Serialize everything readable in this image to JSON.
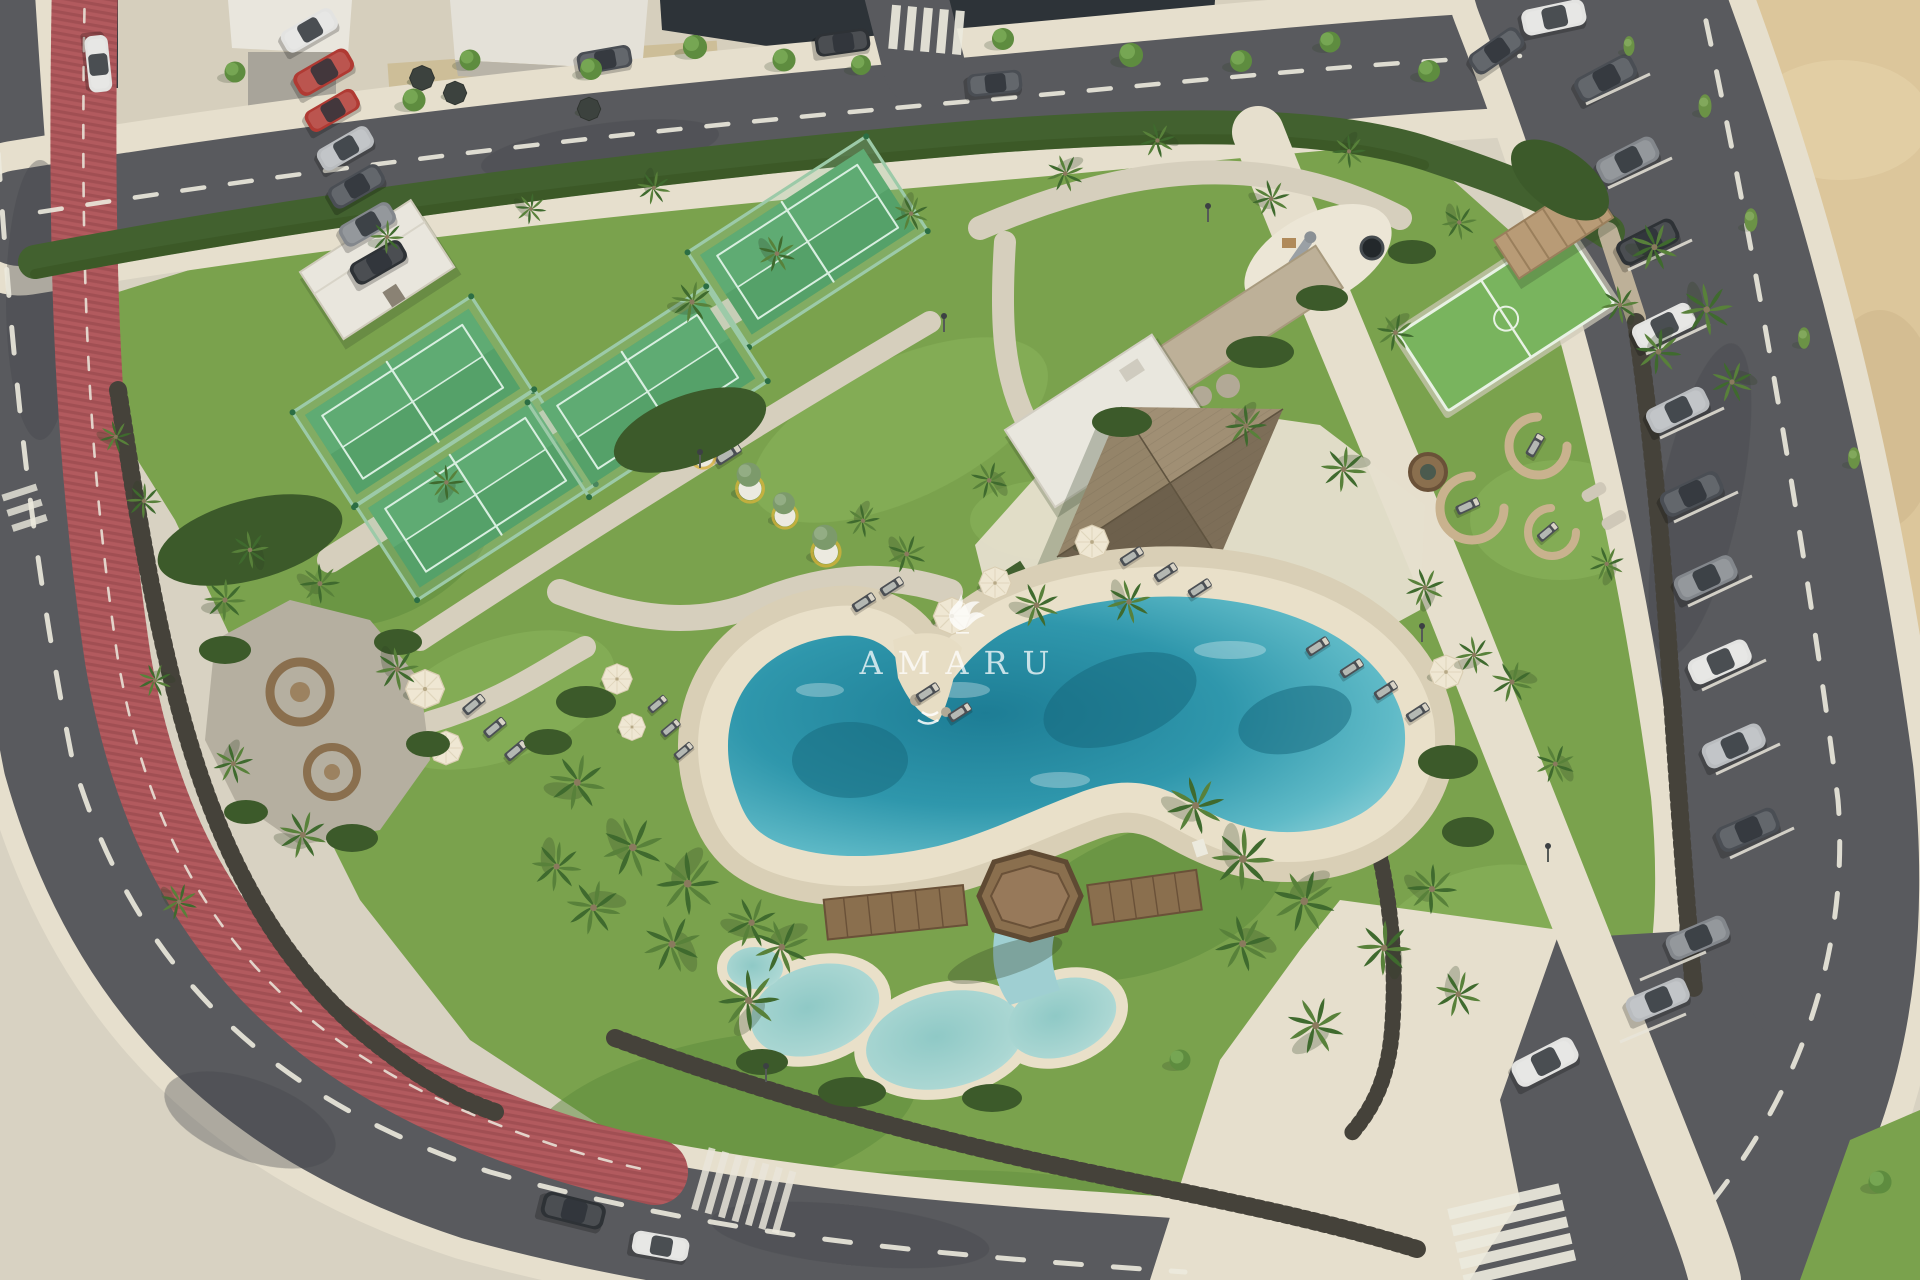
{
  "watermark": {
    "title": "AMARU",
    "logo": "bird-logo"
  },
  "scene": {
    "description_labels": {
      "pool": "lagoon-pool",
      "kids_pool": "kids-pool",
      "gazebo": "wood-gazebo",
      "courts": "padel-courts",
      "pavilion": "club-pavilion",
      "bike_lane": "red-bike-lane",
      "parking": "angled-parking",
      "beach": "sand-area",
      "playground": "playground"
    }
  },
  "colors": {
    "bg": "#d8d2c2",
    "asphalt": "#595a5e",
    "asphaltDark": "#43464a",
    "pave": "#d6cfbd",
    "paveBright": "#e6dfcd",
    "sand": "#dcc69b",
    "grass": "#7aa24d",
    "grassLight": "#8db65e",
    "grassDark": "#5d8a3c",
    "hedge": "#42612f",
    "shrub": "#3c5a2a",
    "frond": "#58813a",
    "frondDark": "#3f6a2e",
    "trunk": "#8a7a5e",
    "bike": "#b25a5e",
    "bikeDark": "#8f4348",
    "court": "#55a169",
    "courtLight": "#6ab57d",
    "courtLine": "#d8efe0",
    "courtPost": "#2c6e44",
    "glass": "#9ccaa8",
    "roofThatch": "#8b7b63",
    "roofRidge": "#5f533f",
    "roofWhite": "#e9e7de",
    "deck": "#e9e0c9",
    "deckEdge": "#d9cfb6",
    "water": "#2f97ac",
    "waterDeep": "#16677c",
    "waterShelf": "#a5dce0",
    "kidsWater": "#abd7d3",
    "wood": "#8a6f4e",
    "woodDark": "#6a5138",
    "podRing": "#c9b28e",
    "gravel": "#b5afa0",
    "fence": "#45423a",
    "wall": "#bdb098",
    "stone": "#b2a996",
    "umbrella": "#efe7d3",
    "lounger": "#4b4f54",
    "carWhite": "#e3e3e1",
    "carSilver": "#b9bcbf",
    "carGray": "#83878c",
    "carDark": "#4a4e54",
    "carBlack": "#2e3236",
    "carRed": "#b03a33",
    "white": "#eceade",
    "shadow": "#2f4024"
  }
}
